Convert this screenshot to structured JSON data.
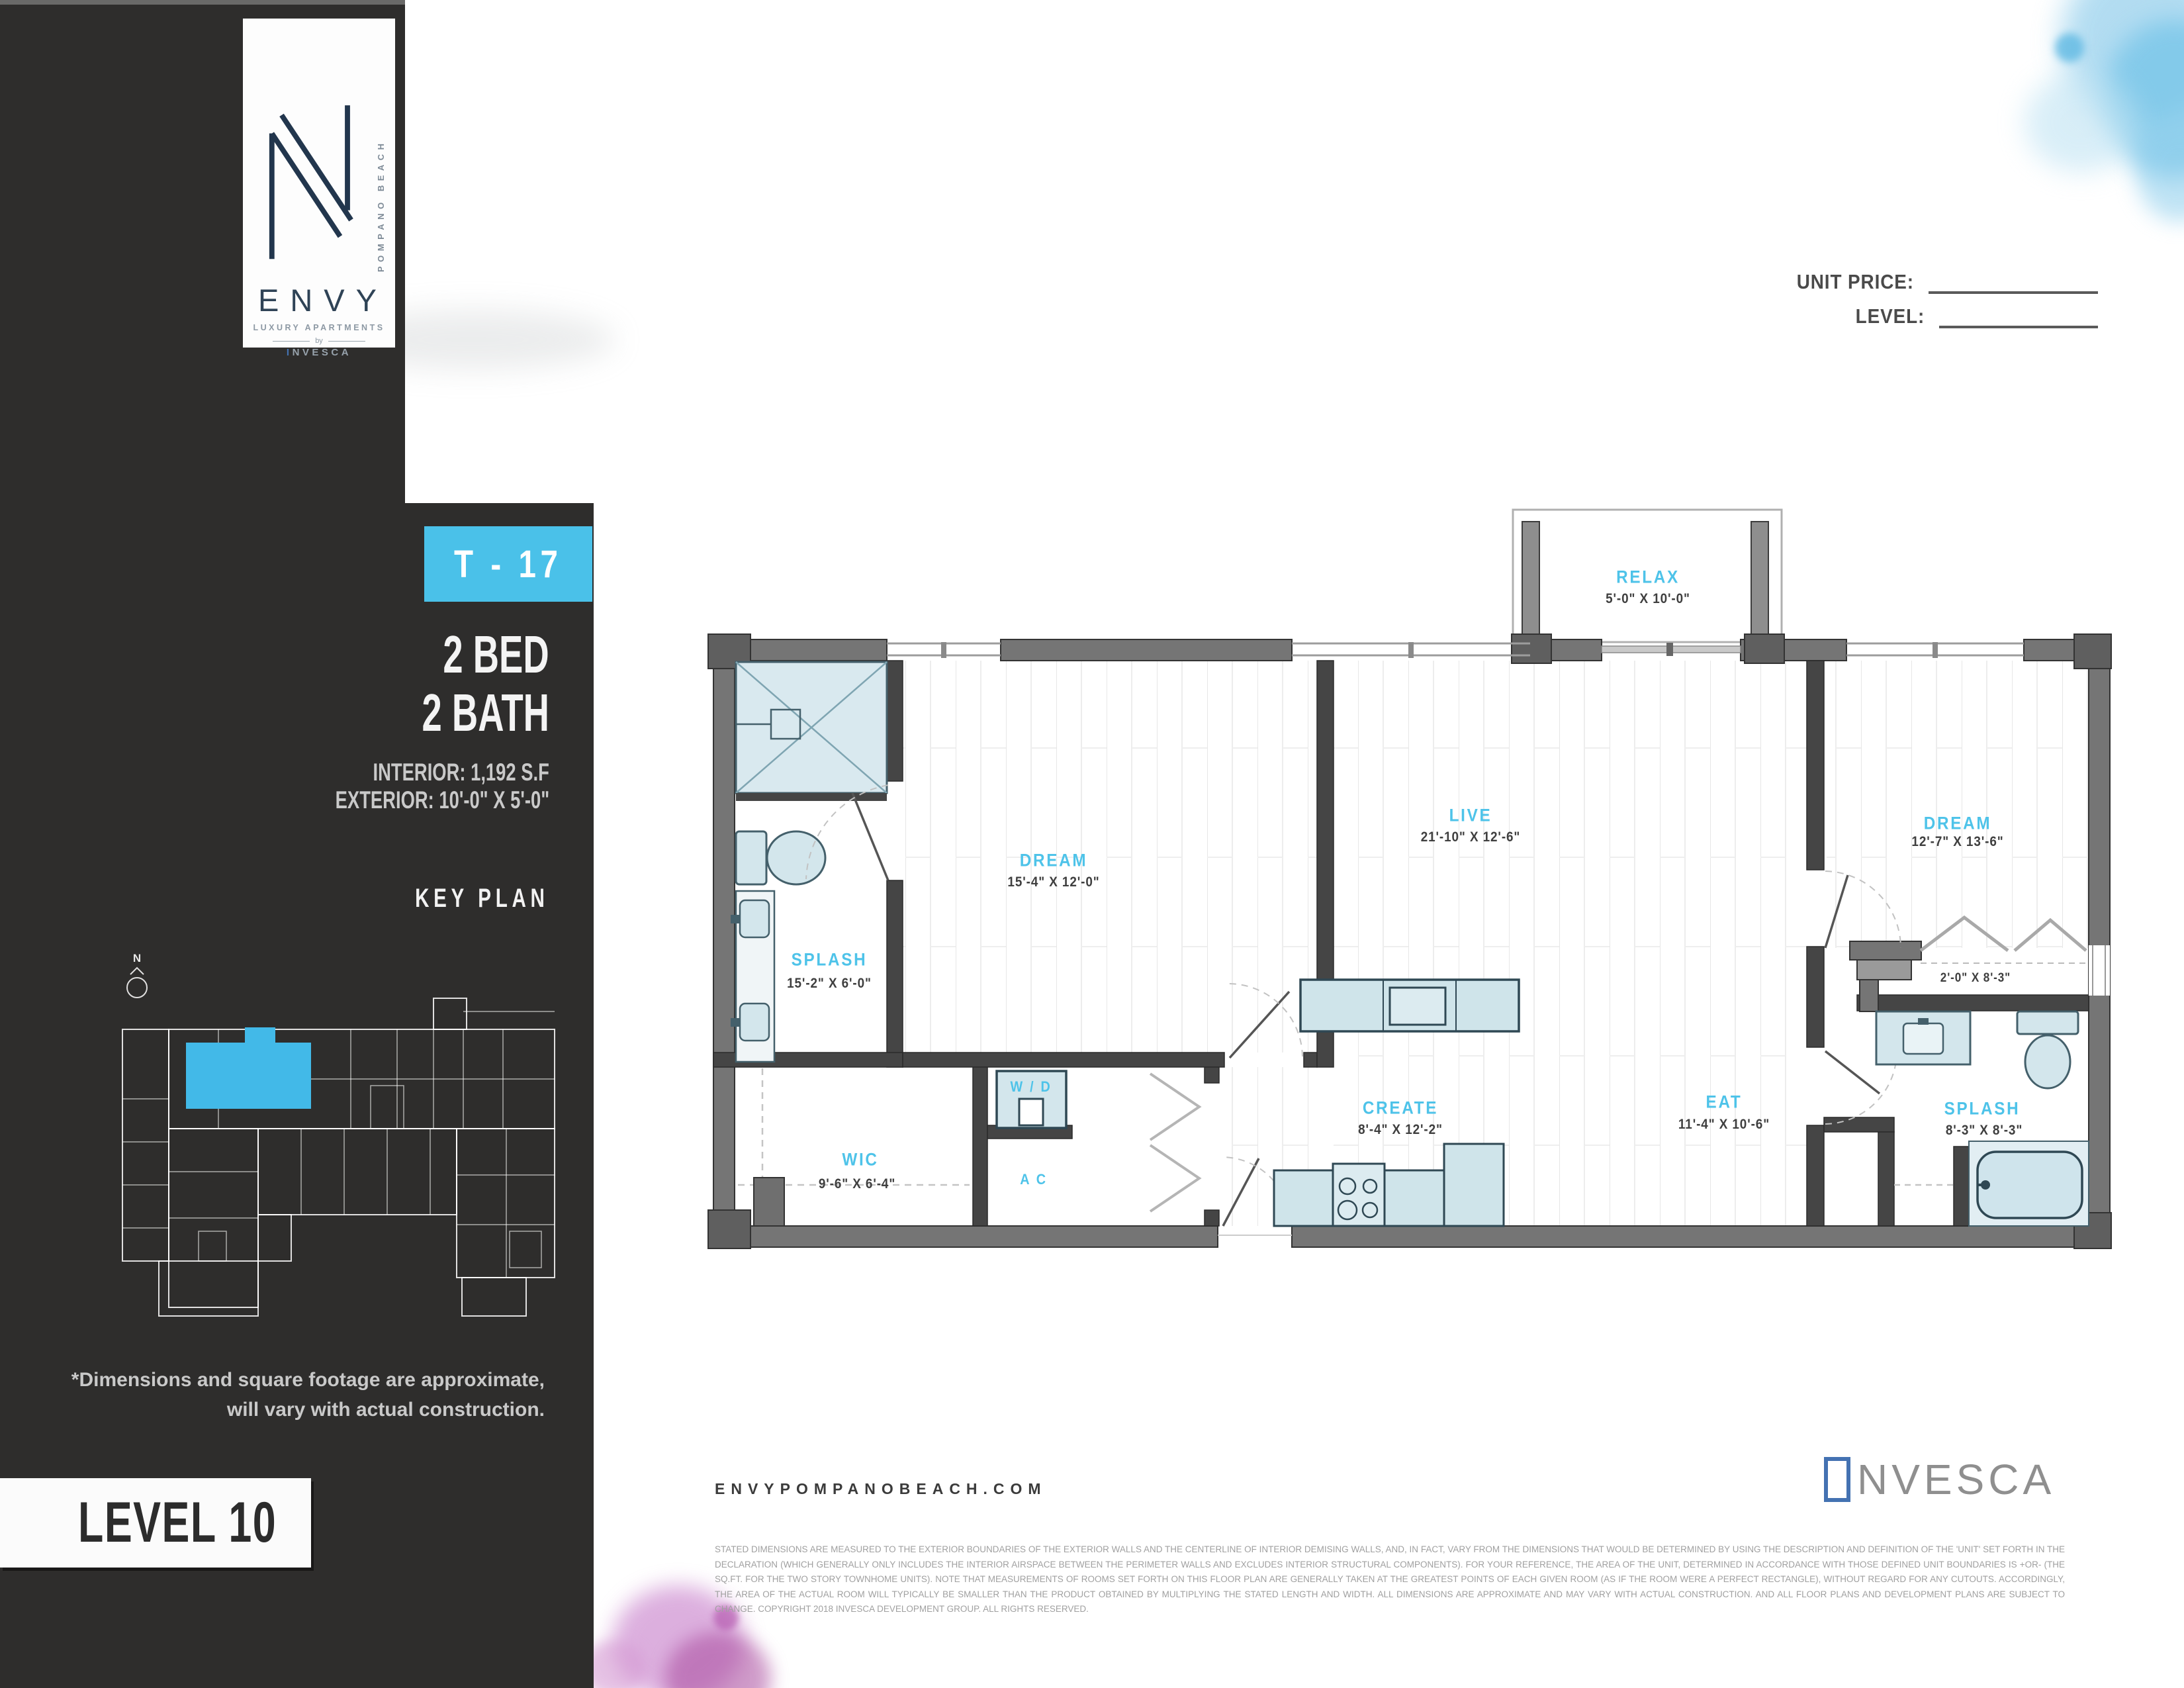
{
  "header": {
    "unit_price_label": "UNIT PRICE:",
    "level_field_label": "LEVEL:"
  },
  "sidebar": {
    "logo": {
      "monogram_vertical_text": "POMPANO BEACH",
      "brand_name": "ENVY",
      "tagline": "LUXURY APARTMENTS",
      "by_text": "by",
      "developer_text": "INVESCA"
    },
    "unit_badge": "T - 17",
    "bed": "2 BED",
    "bath": "2 BATH",
    "interior": "INTERIOR: 1,192 S.F",
    "exterior": "EXTERIOR: 10'-0\" X 5'-0\"",
    "key_plan_title": "KEY PLAN",
    "compass_label": "N",
    "note_line1": "*Dimensions and square footage are approximate,",
    "note_line2": "will vary  with actual construction.",
    "level": "LEVEL 10"
  },
  "floorplan": {
    "accent_color": "#4ec3e9",
    "rooms": [
      {
        "name": "RELAX",
        "dims": "5'-0\" X 10'-0\""
      },
      {
        "name": "DREAM",
        "dims": "15'-4\" X 12'-0\""
      },
      {
        "name": "LIVE",
        "dims": "21'-10\" X 12'-6\""
      },
      {
        "name": "DREAM",
        "dims": "12'-7\" X 13'-6\""
      },
      {
        "name": "SPLASH",
        "dims": "15'-2\" X 6'-0\""
      },
      {
        "name": "WIC",
        "dims": "9'-6\" X 6'-4\""
      },
      {
        "name": "W / D",
        "dims": ""
      },
      {
        "name": "A C",
        "dims": ""
      },
      {
        "name": "CREATE",
        "dims": "8'-4\" X 12'-2\""
      },
      {
        "name": "EAT",
        "dims": "11'-4\" X 10'-6\""
      },
      {
        "name": "SPLASH",
        "dims": "8'-3\" X 8'-3\""
      },
      {
        "name": "",
        "dims": "2'-0\" X 8'-3\""
      }
    ]
  },
  "footer": {
    "website": "ENVYPOMPANOBEACH.COM",
    "developer": {
      "initial": "I",
      "rest": "NVESCA"
    },
    "legal": "STATED DIMENSIONS ARE MEASURED TO THE EXTERIOR BOUNDARIES OF THE EXTERIOR WALLS AND THE CENTERLINE OF INTERIOR DEMISING WALLS, AND, IN FACT, VARY FROM THE DIMENSIONS THAT WOULD BE DETERMINED BY USING THE DESCRIPTION AND DEFINITION OF THE 'UNIT' SET FORTH IN THE DECLARATION (WHICH GENERALLY ONLY INCLUDES THE INTERIOR AIRSPACE BETWEEN THE PERIMETER WALLS AND EXCLUDES INTERIOR STRUCTURAL COMPONENTS). FOR YOUR REFERENCE, THE AREA OF THE UNIT, DETERMINED IN ACCORDANCE WITH THOSE DEFINED UNIT BOUNDARIES IS +OR- (THE SQ.FT. FOR THE TWO STORY TOWNHOME UNITS). NOTE THAT MEASUREMENTS OF ROOMS SET FORTH ON THIS FLOOR PLAN ARE GENERALLY TAKEN AT THE GREATEST POINTS OF EACH GIVEN ROOM (AS IF THE ROOM WERE A PERFECT RECTANGLE), WITHOUT REGARD FOR ANY CUTOUTS. ACCORDINGLY, THE AREA OF THE ACTUAL ROOM WILL TYPICALLY BE SMALLER THAN THE PRODUCT OBTAINED BY MULTIPLYING THE STATED LENGTH AND WIDTH. ALL DIMENSIONS ARE APPROXIMATE AND MAY VARY WITH ACTUAL CONSTRUCTION. AND ALL FLOOR PLANS AND DEVELOPMENT PLANS ARE SUBJECT TO CHANGE. COPYRIGHT 2018 INVESCA DEVELOPMENT GROUP. ALL RIGHTS RESERVED."
  }
}
